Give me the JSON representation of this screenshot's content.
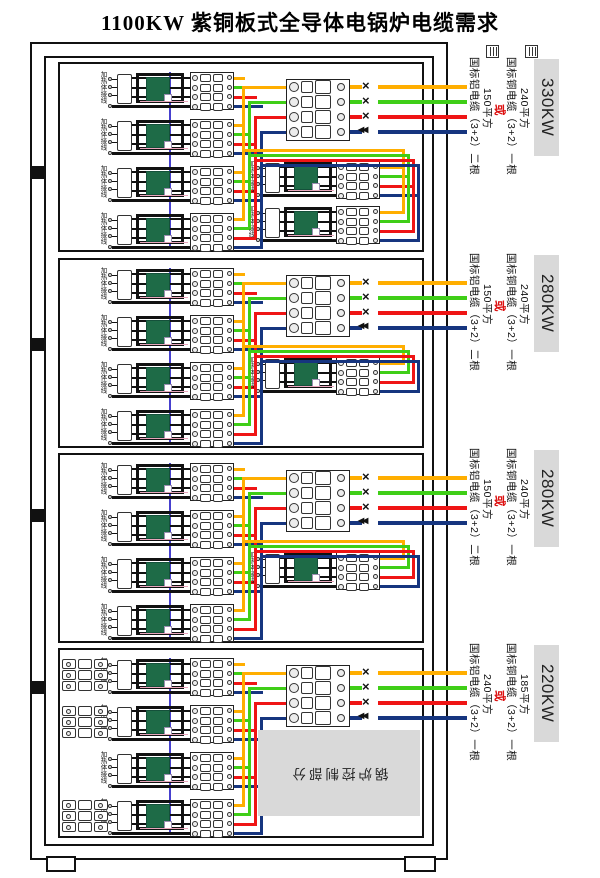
{
  "title": "1100KW 紫铜板式全导体电锅炉电缆需求",
  "heater_label": "加热体接线",
  "joint_symbol": "×",
  "neutral_joint_symbol": "◀◀",
  "colors": {
    "phase_yellow": "#FFAE00",
    "phase_green": "#3FCE17",
    "phase_red": "#EF1515",
    "neutral_blue": "#16357F",
    "neutral_bus": "#4640CE",
    "pink_wire": "#E9A6BC",
    "heater_green": "#1E6B47",
    "panel_gray": "#D9D9D9",
    "or_red": "#DD1111"
  },
  "sections": [
    {
      "power": "330KW",
      "copper_size": "240平方",
      "copper_cable": "国标铜电缆（3+2）一根",
      "or_label": "或",
      "alt_size": "150平方",
      "alt_cable": "国标铝电缆（3+2）二根",
      "left_heaters": 4,
      "middle_heaters": 2,
      "aux_blocks": 0,
      "control_box": ""
    },
    {
      "power": "280KW",
      "copper_size": "240平方",
      "copper_cable": "国标铜电缆（3+2）一根",
      "or_label": "或",
      "alt_size": "150平方",
      "alt_cable": "国标铝电缆（3+2）二根",
      "left_heaters": 4,
      "middle_heaters": 1,
      "aux_blocks": 0,
      "control_box": ""
    },
    {
      "power": "280KW",
      "copper_size": "240平方",
      "copper_cable": "国标铜电缆（3+2）一根",
      "or_label": "或",
      "alt_size": "150平方",
      "alt_cable": "国标铝电缆（3+2）二根",
      "left_heaters": 4,
      "middle_heaters": 1,
      "aux_blocks": 0,
      "control_box": ""
    },
    {
      "power": "220KW",
      "copper_size": "185平方",
      "copper_cable": "国标铜电缆（3+2）一根",
      "or_label": "或",
      "alt_size": "240平方",
      "alt_cable": "国标铝电缆（3+2）一根",
      "left_heaters": 4,
      "middle_heaters": 0,
      "aux_blocks": 3,
      "control_box": "锅炉控制部分"
    }
  ]
}
